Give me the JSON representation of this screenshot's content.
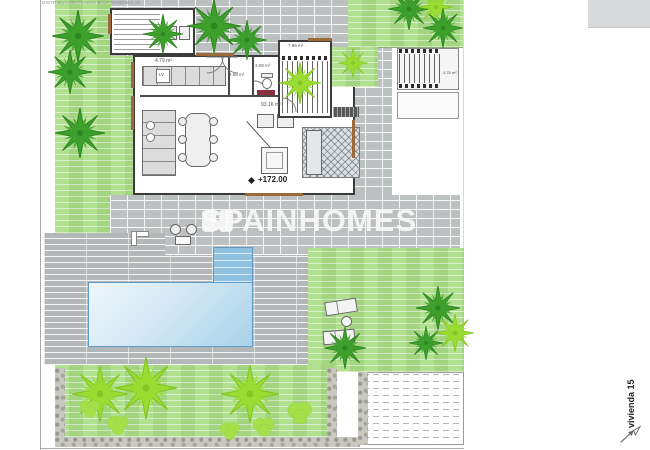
{
  "document": {
    "header_note": "DISTRIBUCIÓN PLANTA BAJA VIVIENDA 15",
    "sheet_label": "vivienda 15"
  },
  "watermark": {
    "brand": "SPAINHOMES"
  },
  "plan_labels": {
    "utility_area": "4.79 m²",
    "laundry_appliance": "LV",
    "hall_area": "2.58 m²",
    "wc_area": "3.08 m²",
    "stairs_area": "7.86 m²",
    "living_kitchen_area": "93.16 m²",
    "floor_level": "+172.00",
    "exterior_stair_label": "4.78 m²"
  },
  "colors": {
    "lawn": "#a9dc85",
    "palm_dark": "#3da02c",
    "palm_dark_stroke": "#2e8520",
    "palm_light": "#9bdc33",
    "palm_light_stroke": "#84c724",
    "bush": "#a5e04a",
    "bush_stroke": "#8cc930",
    "paving": "#bdc0c1",
    "decking": "#b4b7b8",
    "pool_water": "#cfe7f5",
    "pool_edge": "#5e9cc7",
    "wall": "#3c3c3c",
    "wood_frame": "#9c6b3c",
    "stone": "#c9c9c1",
    "watermark_white": "rgba(255,255,255,0.82)"
  },
  "trees": [
    {
      "x": 78,
      "y": 36,
      "s": 52,
      "t": "dark"
    },
    {
      "x": 70,
      "y": 72,
      "s": 44,
      "t": "dark"
    },
    {
      "x": 80,
      "y": 133,
      "s": 50,
      "t": "dark"
    },
    {
      "x": 163,
      "y": 34,
      "s": 40,
      "t": "dark"
    },
    {
      "x": 214,
      "y": 26,
      "s": 54,
      "t": "dark"
    },
    {
      "x": 247,
      "y": 40,
      "s": 40,
      "t": "dark"
    },
    {
      "x": 300,
      "y": 83,
      "s": 42,
      "t": "light"
    },
    {
      "x": 353,
      "y": 63,
      "s": 30,
      "t": "light"
    },
    {
      "x": 409,
      "y": 9,
      "s": 42,
      "t": "dark"
    },
    {
      "x": 436,
      "y": 7,
      "s": 34,
      "t": "light"
    },
    {
      "x": 443,
      "y": 28,
      "s": 40,
      "t": "dark"
    },
    {
      "x": 345,
      "y": 348,
      "s": 42,
      "t": "dark"
    },
    {
      "x": 438,
      "y": 308,
      "s": 44,
      "t": "dark"
    },
    {
      "x": 455,
      "y": 333,
      "s": 38,
      "t": "light"
    },
    {
      "x": 426,
      "y": 343,
      "s": 34,
      "t": "dark"
    },
    {
      "x": 100,
      "y": 394,
      "s": 56,
      "t": "light"
    },
    {
      "x": 146,
      "y": 388,
      "s": 62,
      "t": "light"
    },
    {
      "x": 250,
      "y": 394,
      "s": 58,
      "t": "light"
    },
    {
      "x": 118,
      "y": 424,
      "s": 26,
      "t": "bush"
    },
    {
      "x": 230,
      "y": 430,
      "s": 24,
      "t": "bush"
    },
    {
      "x": 264,
      "y": 426,
      "s": 26,
      "t": "bush"
    },
    {
      "x": 300,
      "y": 412,
      "s": 30,
      "t": "bush"
    },
    {
      "x": 90,
      "y": 408,
      "s": 24,
      "t": "bush"
    }
  ]
}
